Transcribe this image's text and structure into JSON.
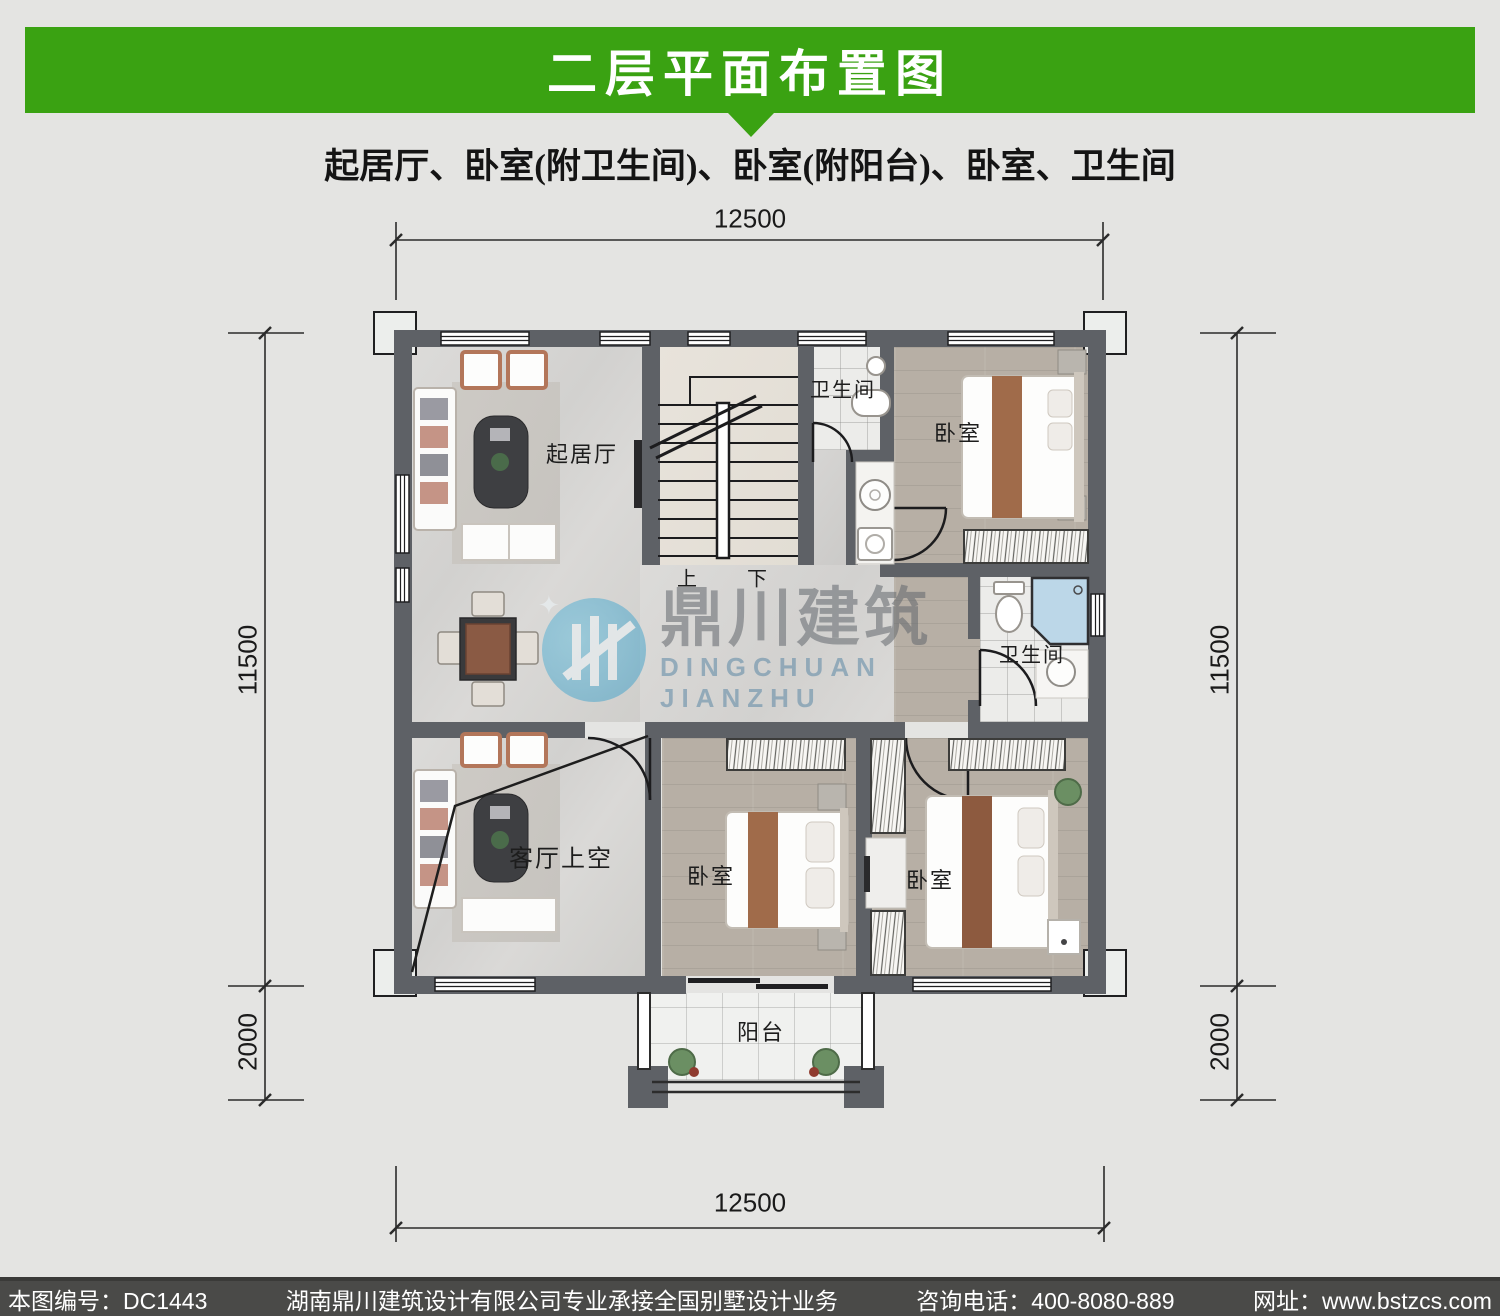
{
  "page_title": "二层平面布置图",
  "subtitle": "起居厅、卧室(附卫生间)、卧室(附阳台)、卧室、卫生间",
  "watermark": {
    "logo": "鼎川建筑",
    "logo_en": "DINGCHUAN JIANZHU"
  },
  "plan": {
    "rooms": {
      "living": "起居厅",
      "bath_top": "卫生间",
      "bed_top_right": "卧室",
      "bath_mid": "卫生间",
      "void_over_living": "客厅上空",
      "bed_bottom_mid": "卧室",
      "bed_bottom_right": "卧室",
      "balcony": "阳台",
      "stair_up": "上",
      "stair_down": "下"
    },
    "dimensions": {
      "top_width": "12500",
      "bottom_width": "12500",
      "left_depth": "11500",
      "left_balcony": "2000",
      "right_depth": "11500",
      "right_balcony": "2000"
    }
  },
  "footer": {
    "drawing_no": "本图编号：DC1443",
    "company": "湖南鼎川建筑设计有限公司专业承接全国别墅设计业务",
    "phone": "咨询电话：400-8080-889",
    "website": "网址：www.bstzcs.com"
  },
  "colors": {
    "accent_green": "#3aa212",
    "wall_gray": "#5e6166",
    "footer_bg": "#4a4a48",
    "shower_blue": "#bcd7e8"
  }
}
